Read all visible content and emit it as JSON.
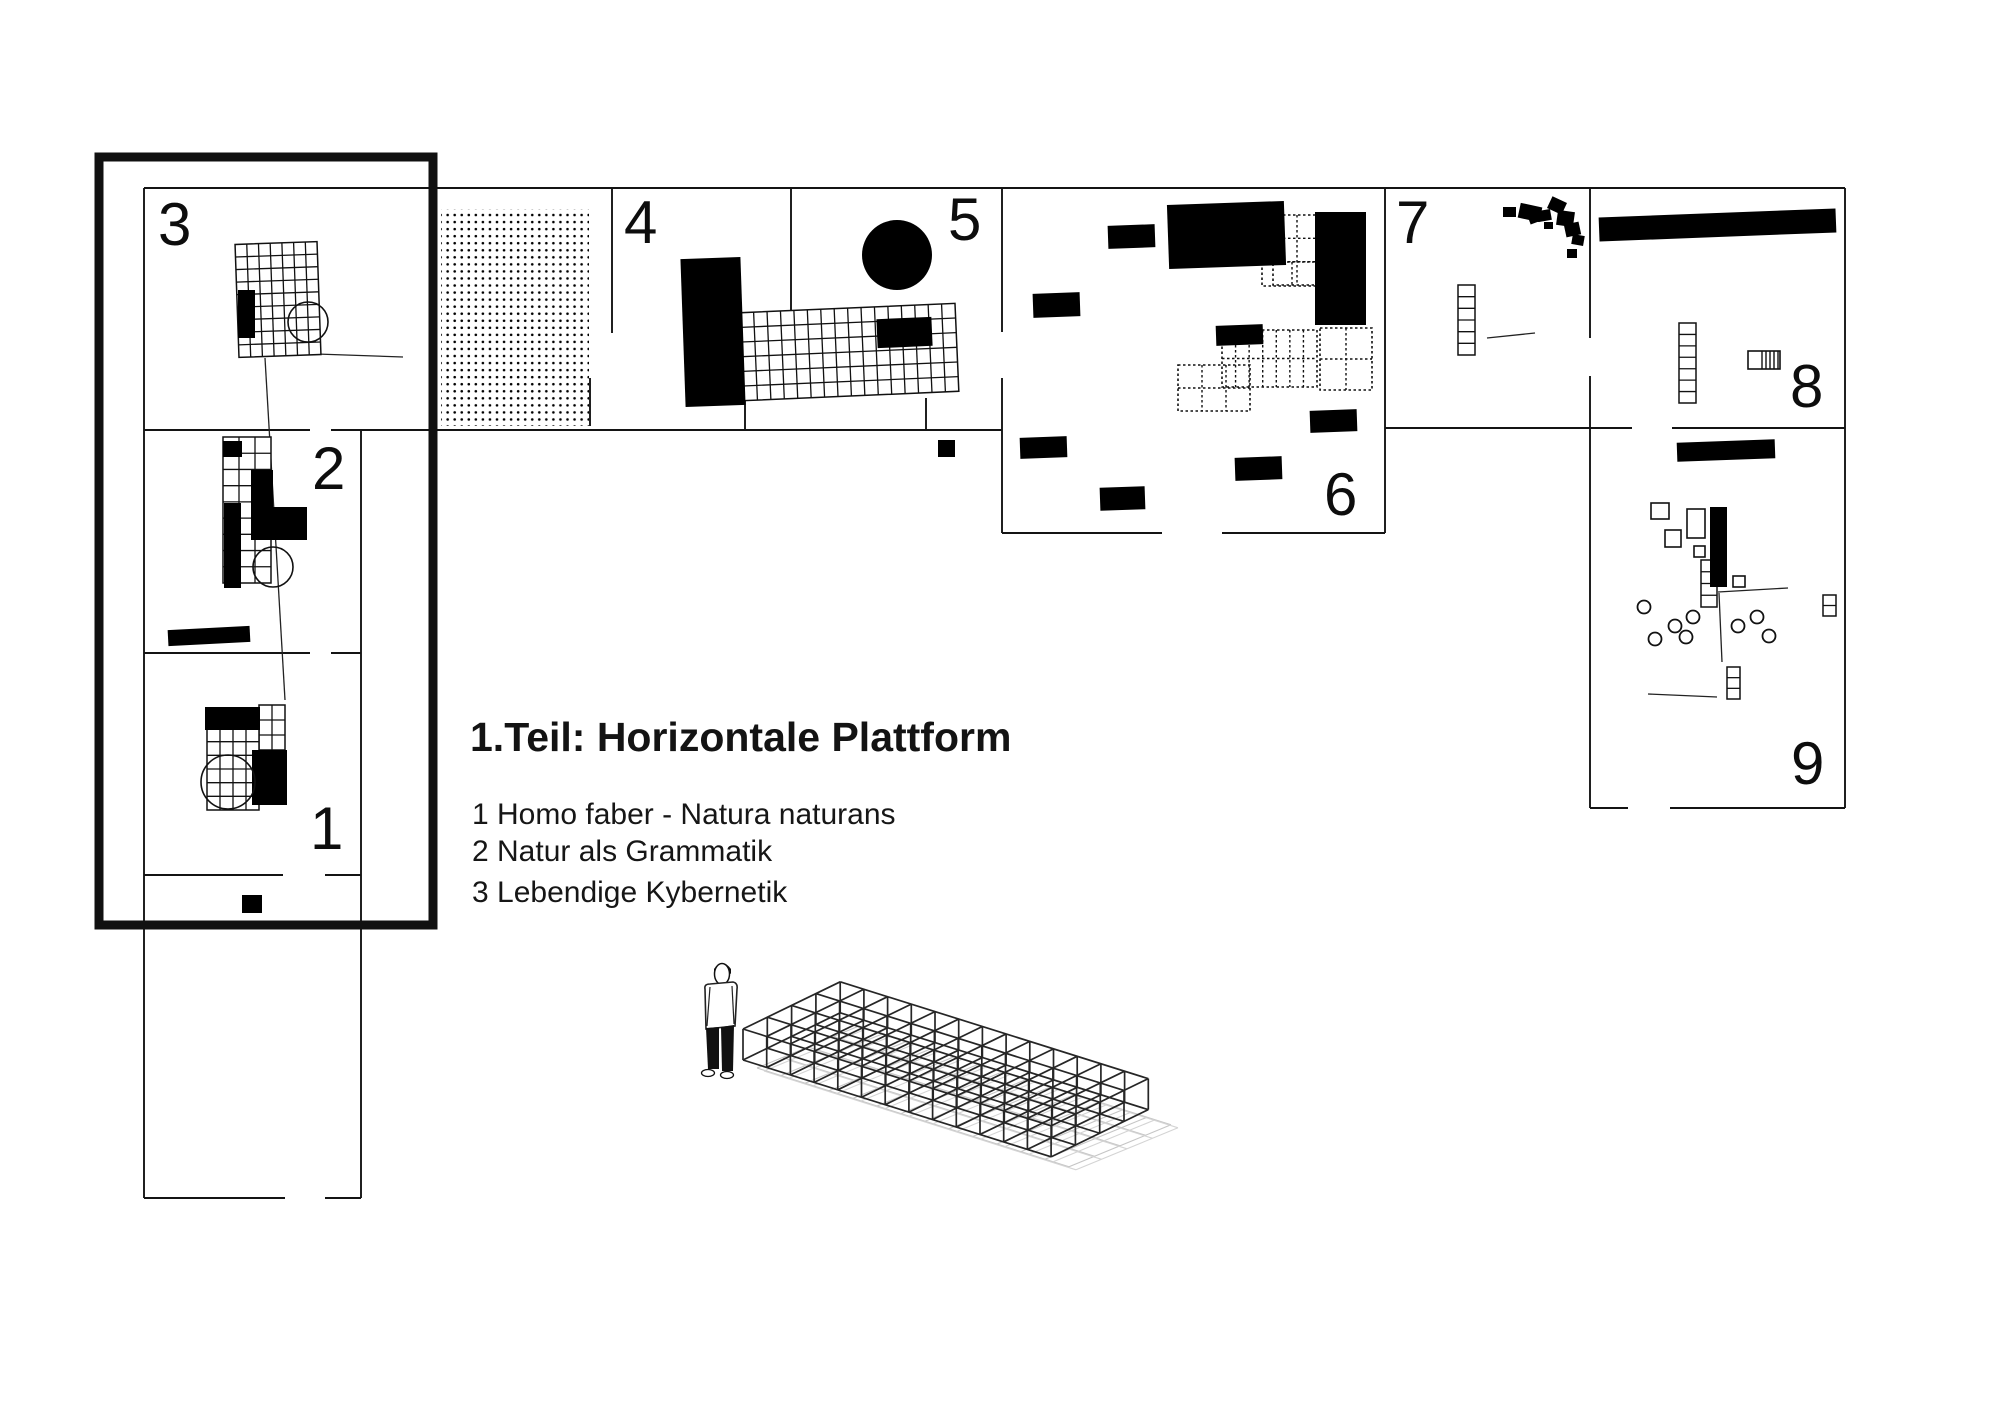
{
  "title_block": {
    "title": "1.Teil: Horizontale Plattform",
    "legend": [
      "1 Homo faber - Natura naturans",
      "2 Natur als Grammatik",
      "3 Lebendige Kybernetik"
    ]
  },
  "plan": {
    "section_labels": [
      "1",
      "2",
      "3",
      "4",
      "5",
      "6",
      "7",
      "8",
      "9"
    ],
    "highlighted_sections": [
      "1",
      "2",
      "3"
    ],
    "colors": {
      "ink": "#000000",
      "wall": "#141414",
      "grid": "#111111",
      "frame": "#111111",
      "shadow": "#c5c5c5",
      "shadow_light": "#d4d4d4"
    },
    "icons": [
      "exhibit-grid-platform-icon",
      "exhibit-block-icon",
      "dot-field-icon",
      "dashed-grid-icon",
      "circle-marker-icon",
      "scatter-blob-icon"
    ]
  },
  "scale_model": {
    "figure_icon": "human-figure-icon",
    "structure_icon": "wireframe-platform-icon",
    "cells_long": 13,
    "cells_wide": 4,
    "cells_high": 1
  }
}
